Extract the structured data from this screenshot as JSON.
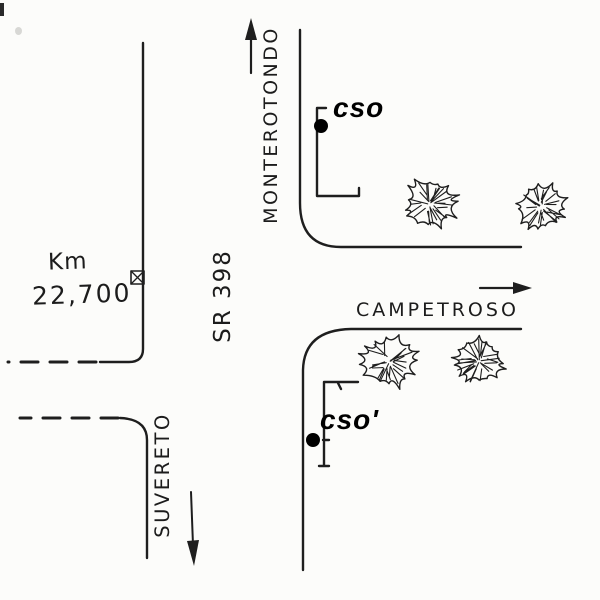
{
  "labels": {
    "north_destination": "MONTEROTONDO",
    "road_name": "SR 398",
    "south_destination": "SUVERETO",
    "side_road": "CAMPETROSO",
    "km_label": "Km",
    "km_value": "22,700",
    "observation_point": "cso",
    "observation_point_prime": "cso'"
  },
  "colors": {
    "ink": "#1e1e1e",
    "paper": "#fcfcfa",
    "label_ink": "#000000"
  },
  "map": {
    "trees": [
      {
        "cx": 430,
        "cy": 204,
        "r": 27
      },
      {
        "cx": 541,
        "cy": 207,
        "r": 25
      },
      {
        "cx": 389,
        "cy": 362,
        "r": 28
      },
      {
        "cx": 479,
        "cy": 361,
        "r": 26
      }
    ],
    "markers": {
      "km_box": {
        "x": 131,
        "y": 271,
        "size": 13
      },
      "dot_cso": {
        "cx": 321,
        "cy": 126,
        "r": 7
      },
      "dot_cso_prime": {
        "cx": 313,
        "cy": 440,
        "r": 7
      }
    }
  }
}
